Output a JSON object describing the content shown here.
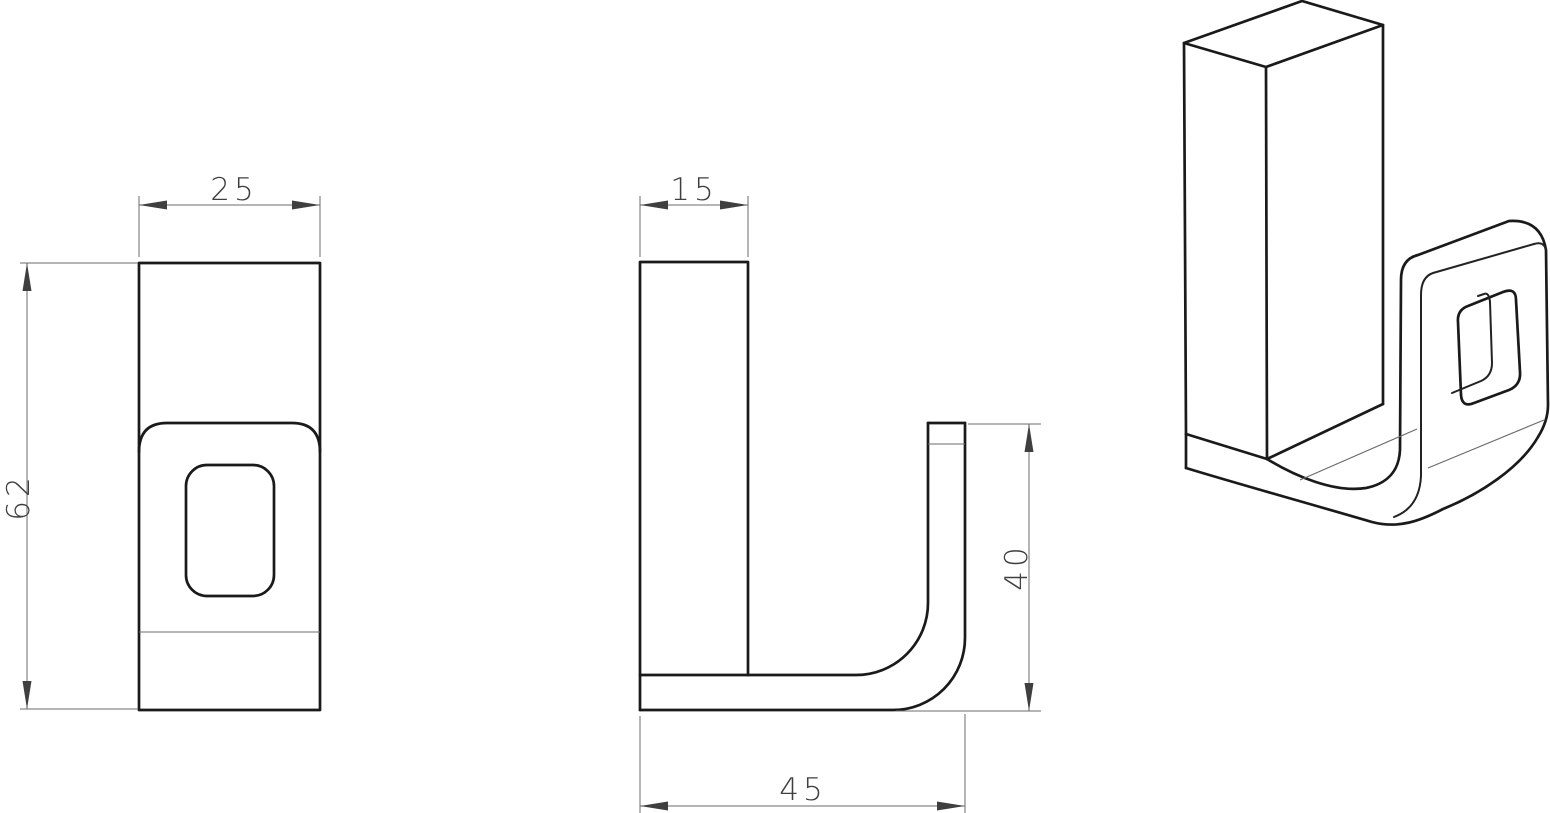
{
  "drawing": {
    "dimensions": {
      "front_width": "25",
      "front_height": "62",
      "side_width": "15",
      "hook_height": "40",
      "base_depth": "45"
    },
    "colors": {
      "outline": "#1a1a1a",
      "dimension_line": "#6b6b6b",
      "dimension_text": "#3f3f3f",
      "background": "#ffffff"
    }
  }
}
